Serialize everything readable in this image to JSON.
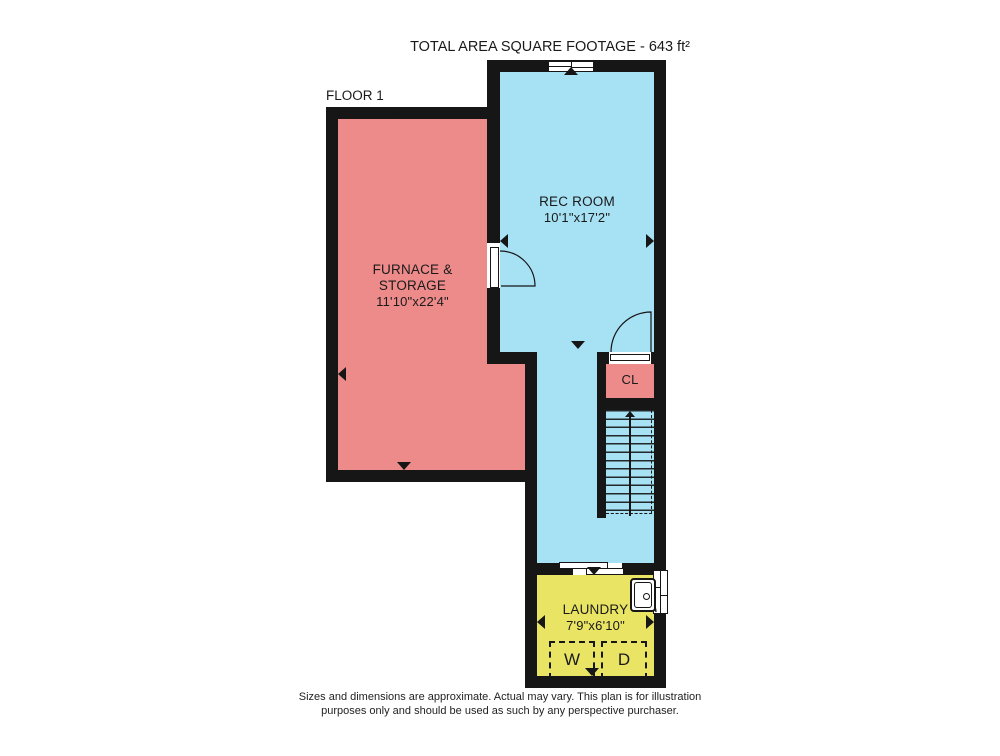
{
  "title": "TOTAL AREA SQUARE FOOTAGE - 643 ft²",
  "floor_label": "FLOOR 1",
  "rooms": {
    "furnace": {
      "name": "FURNACE & STORAGE",
      "dims": "11'10\"x22'4\""
    },
    "rec": {
      "name": "REC ROOM",
      "dims": "10'1\"x17'2\""
    },
    "closet": {
      "name": "CL"
    },
    "laundry": {
      "name": "LAUNDRY",
      "dims": "7'9\"x6'10\"",
      "washer_label": "W",
      "dryer_label": "D"
    }
  },
  "footer": {
    "line1": "Sizes and dimensions are approximate. Actual may vary. This plan is for illustration",
    "line2": "purposes only and should be used as such by any perspective purchaser."
  },
  "colors": {
    "wall": "#161616",
    "furnace": "#ED8A8A",
    "rec": "#A7E1F4",
    "closet": "#ED8A8A",
    "laundry": "#E9E464"
  }
}
